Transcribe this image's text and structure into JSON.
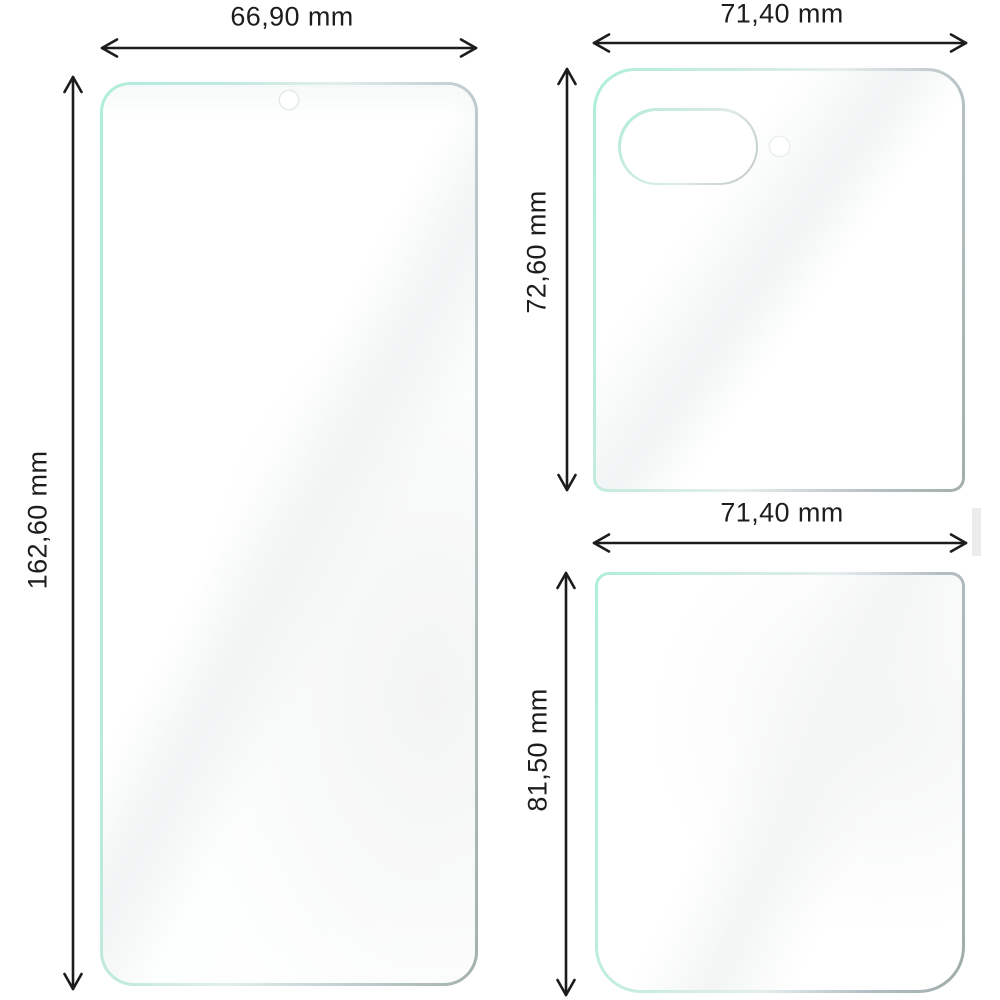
{
  "diagram": {
    "unit": "mm",
    "films": [
      {
        "name": "front-screen-film",
        "width_label": "66,90 mm",
        "height_label": "162,60 mm"
      },
      {
        "name": "outer-cover-film",
        "width_label": "71,40 mm",
        "height_label": "72,60 mm"
      },
      {
        "name": "back-panel-film",
        "width_label": "71,40 mm",
        "height_label": "81,50 mm"
      }
    ],
    "colors": {
      "film_edge_mint": "#aeeedb",
      "film_edge_gray": "#a2afab",
      "film_surface": "#ffffff",
      "dimension_line": "#1c1c1e",
      "label_text": "#1d1d1f"
    }
  }
}
